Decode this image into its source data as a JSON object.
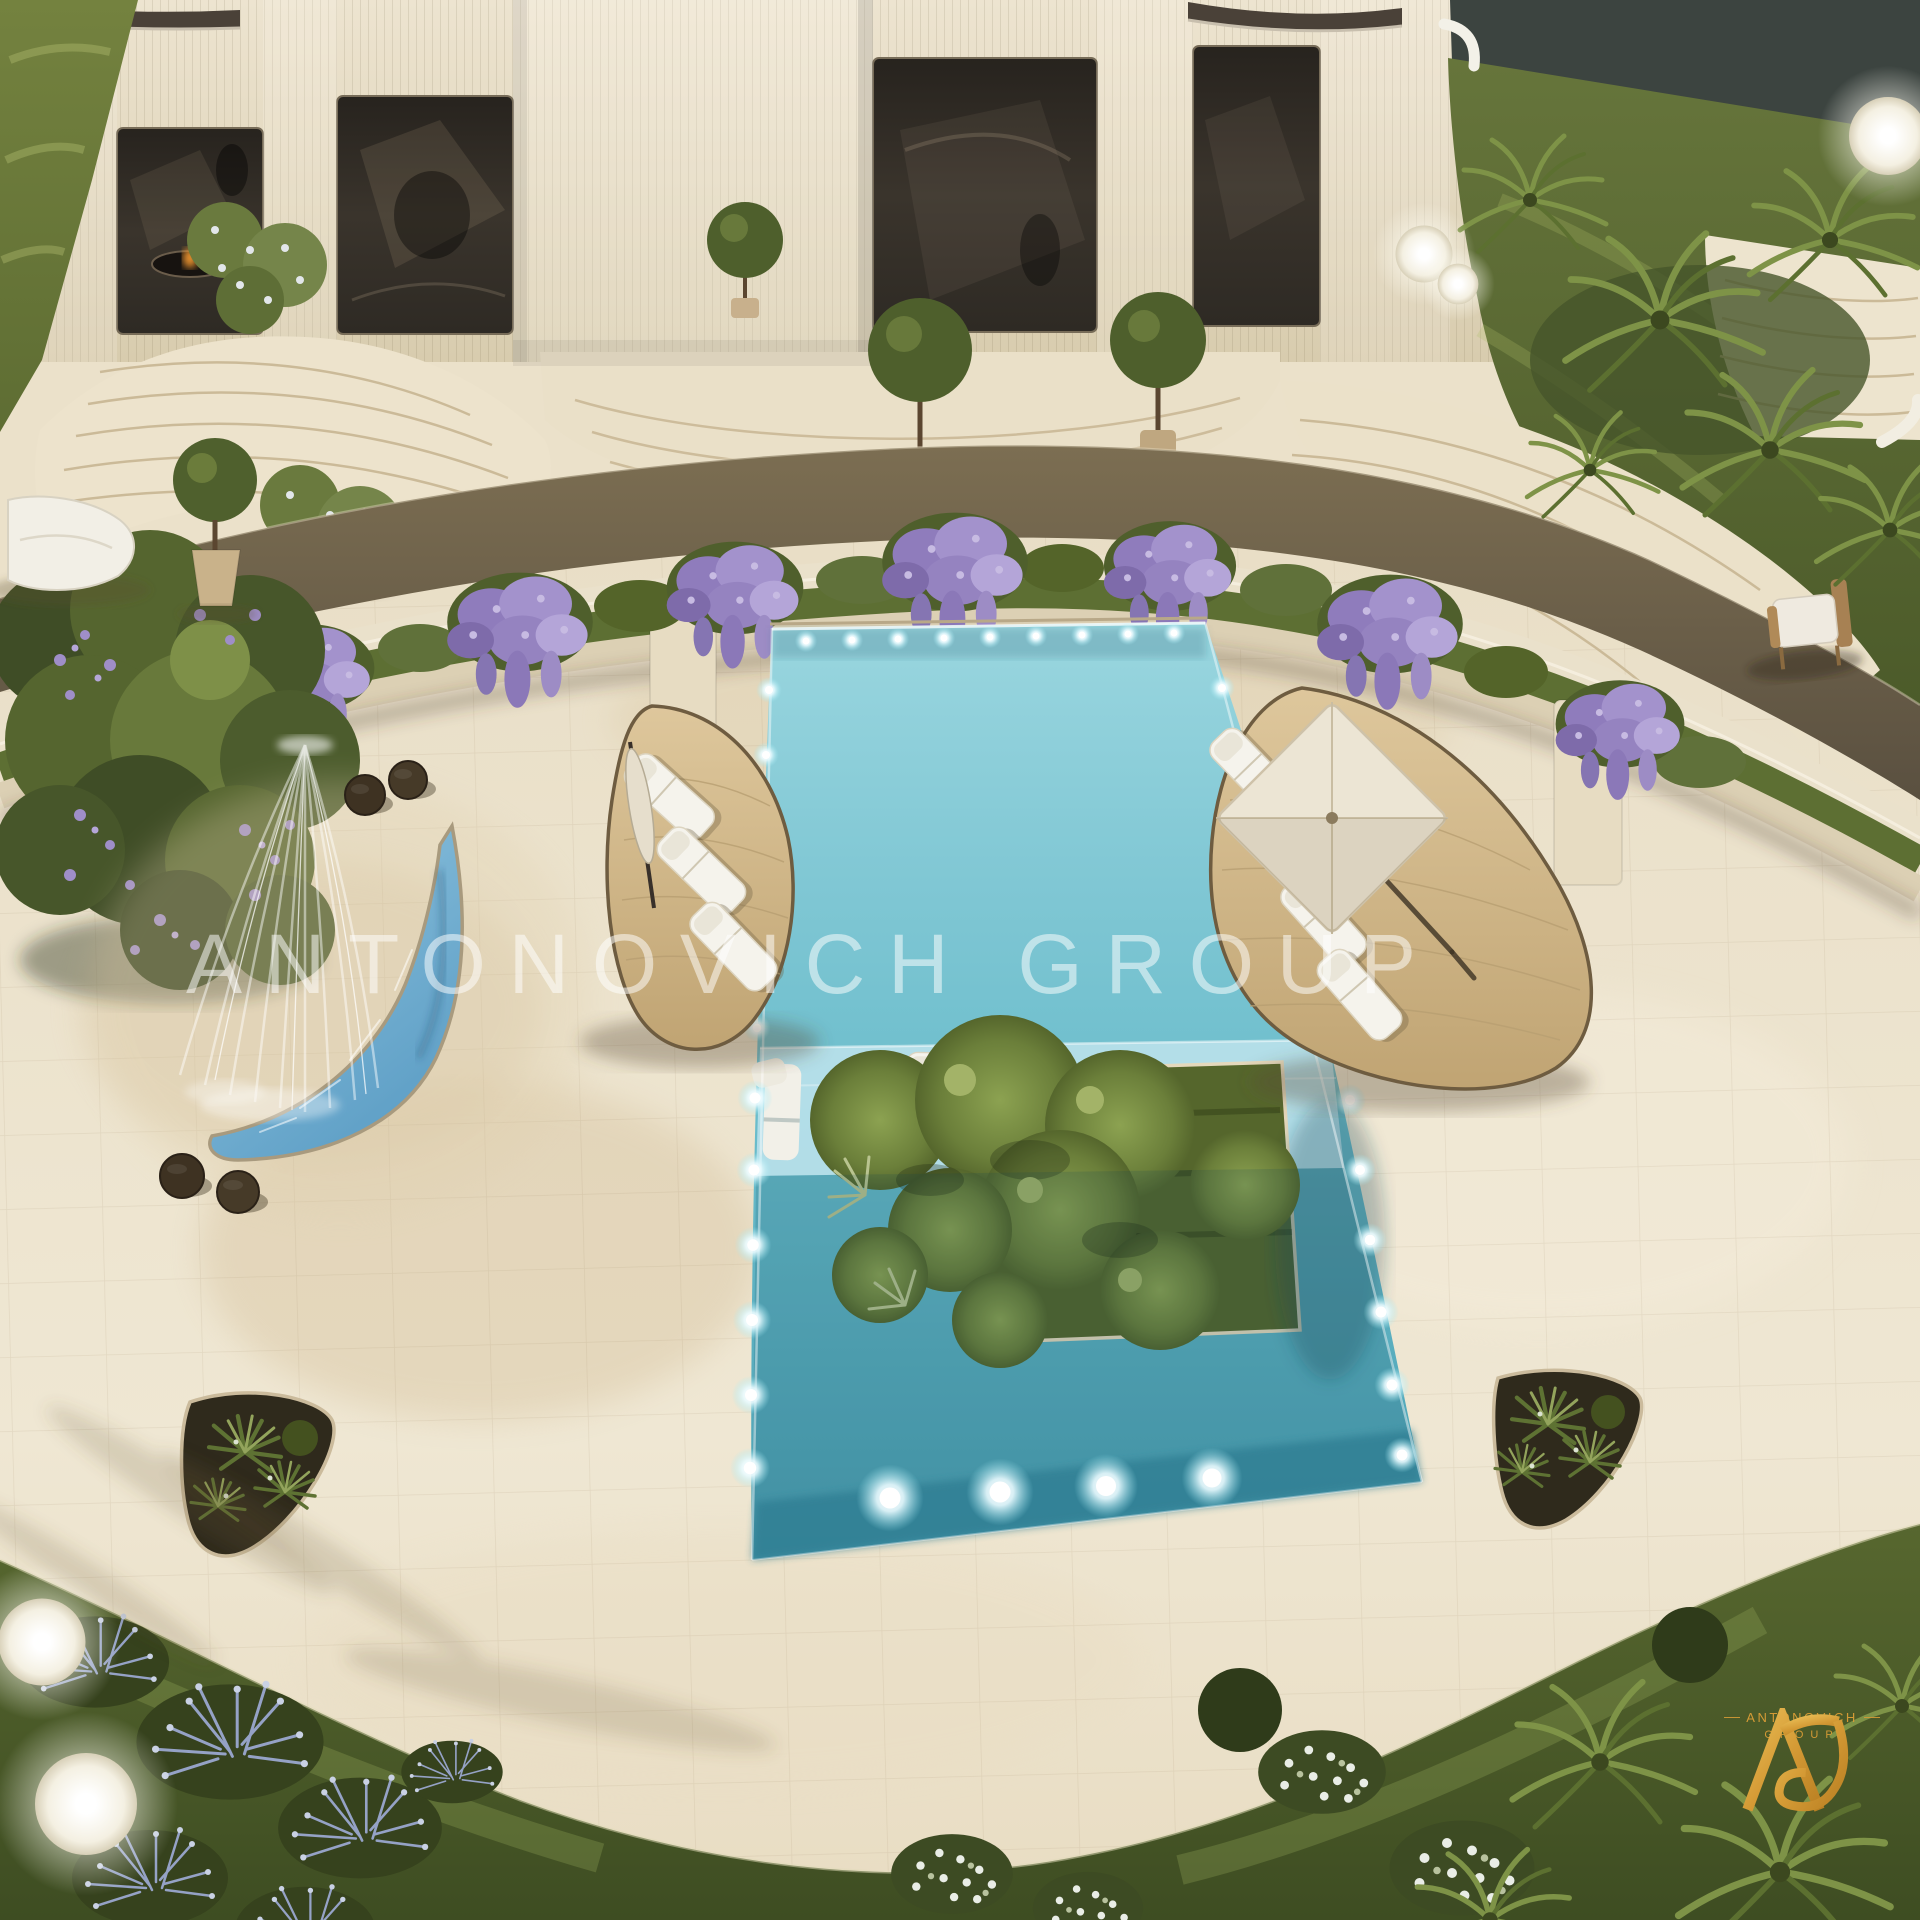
{
  "watermark": {
    "text": "ANTONOVICH GROUP"
  },
  "logo": {
    "monogram": "AG",
    "name": "ANTONOVICH",
    "subtitle": "GROUP",
    "gold": "#D49A35"
  },
  "scene": {
    "type": "aerial-architectural-render",
    "subject": "luxury villa courtyard with swimming pool",
    "palette": {
      "marble_paving": "#EAE0C9",
      "facade_stone": "#E4D9C2",
      "window_glass": "#352F28",
      "pool_water": "#6ABCCB",
      "pool_shallow_shelf": "#B8E0E9",
      "pond_water": "#6FAED4",
      "wood_deck": "#D5BC8E",
      "walkway_band": "#6E614A",
      "lawn_green": "#5E6D33",
      "planter_green": "#5D6F33",
      "bougainvillea_purple": "#9D8CC5",
      "lounger_white": "#F5F3EC",
      "underwater_light": "#FFFFFF",
      "logo_gold": "#D49A35"
    },
    "elements": [
      "villa-facade",
      "glass-window",
      "rooftop-rail",
      "curved-steps",
      "walkway-band",
      "flower-terrace",
      "terrace-pillar",
      "topiary-tree",
      "swimming-pool",
      "pool-shallow-shelf",
      "pool-island",
      "island-tree-canopy",
      "underwater-light",
      "in-pool-lounger",
      "wood-deck",
      "sun-lounger",
      "parasol",
      "fountain-bush",
      "waterfall-jets",
      "crescent-pond",
      "pool-stool",
      "garden-chair",
      "planter-island",
      "lawn",
      "lavender-bed",
      "white-flower-bed",
      "palm-plant",
      "glow-sphere-lamp",
      "watermark",
      "brand-logo"
    ]
  }
}
